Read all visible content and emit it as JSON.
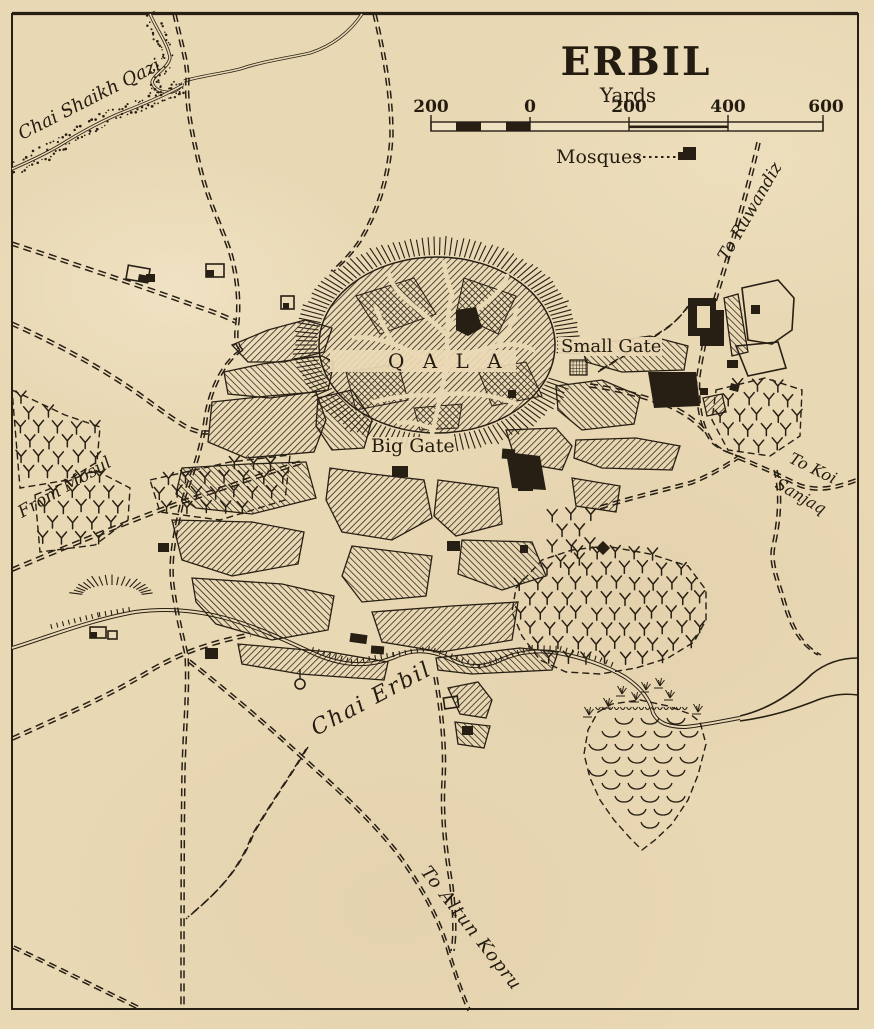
{
  "map": {
    "title": "ERBIL",
    "scale_unit": "Yards",
    "scale_ticks": [
      "200",
      "0",
      "200",
      "400",
      "600"
    ],
    "legend_mosques": "Mosques",
    "labels": {
      "stream_nw": "Chai Shaikh Qazi",
      "road_ruwandiz": "To Ruwandiz",
      "small_gate": "Small Gate",
      "citadel": "Q A L A",
      "big_gate": "Big Gate",
      "road_mosul": "From Mosul",
      "road_koi_line1": "To Koi",
      "road_koi_line2": "Sanjaq",
      "river_erbil": "Chai Erbil",
      "road_altun": "To Altun Kopru"
    }
  }
}
